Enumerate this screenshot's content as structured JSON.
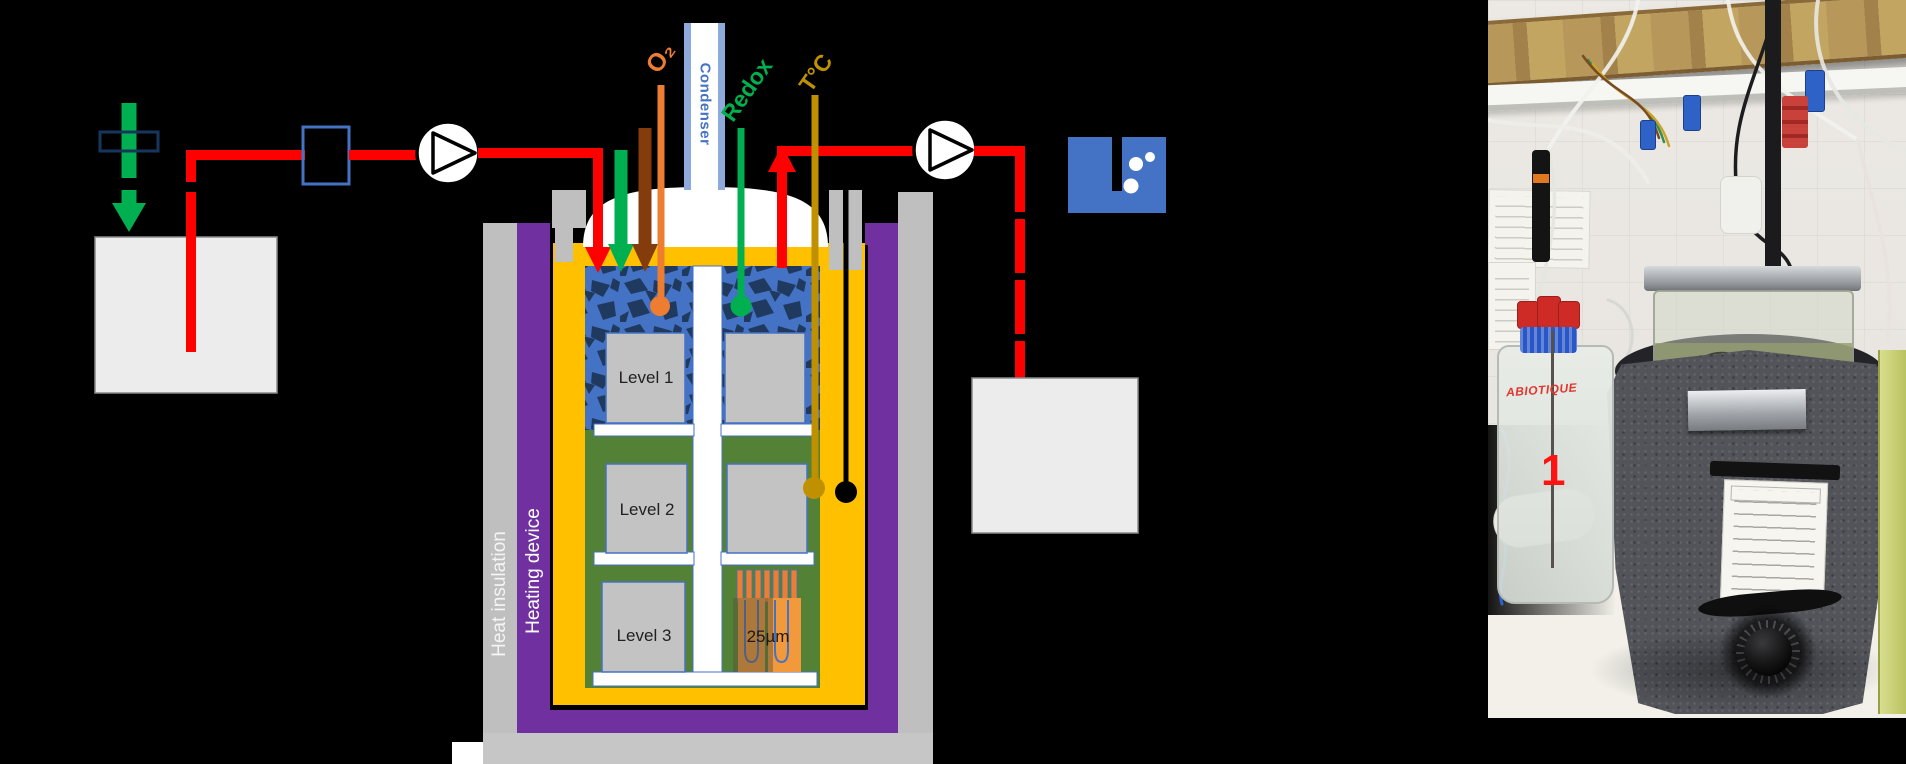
{
  "figure": {
    "diagram": {
      "sensor_labels": {
        "o2": "O₂",
        "condenser": "Condenser",
        "redox": "Redox",
        "temperature": "T°C"
      },
      "layers": {
        "heat_insulation": "Heat insulation",
        "heating_device": "Heating device"
      },
      "levels": {
        "level1": "Level 1",
        "level2": "Level 2",
        "level3": "Level 3"
      },
      "microchannel_label": "25µm",
      "colors": {
        "pipe_red": "#FF0000",
        "gas_green": "#00B050",
        "feed_brown": "#843C0C",
        "o2_orange": "#ED7D31",
        "temperature_gold": "#BF9000",
        "diagram_blue": "#4472C4",
        "condenser_light_blue": "#8EAADB",
        "vessel_yellow": "#FFC000",
        "heating_purple": "#7030A0",
        "insulation_gray": "#BFBFBF",
        "bed_green": "#538135"
      }
    },
    "photo": {
      "bottle_label": "ABIOTIQUE",
      "item_number": "1"
    }
  }
}
